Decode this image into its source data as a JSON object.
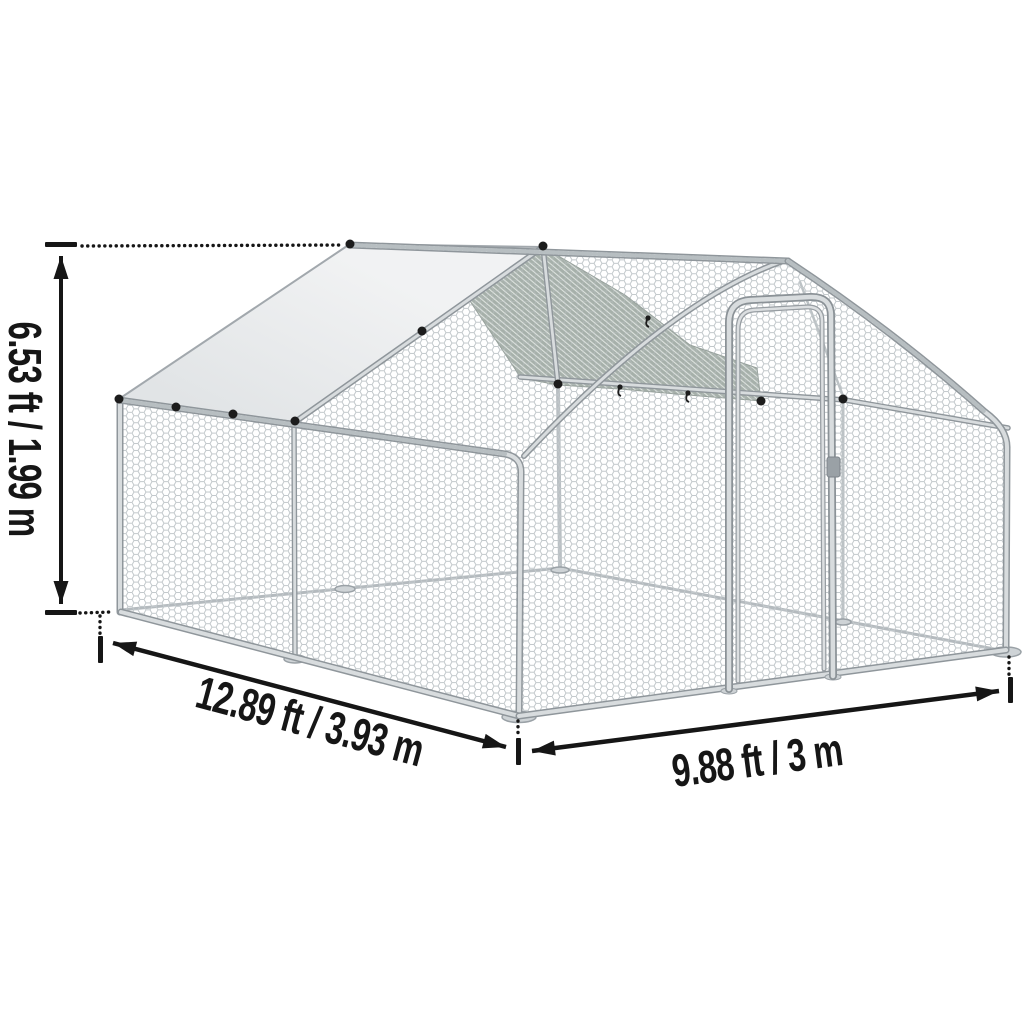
{
  "diagram": {
    "dimensions": {
      "height": "6.53 ft / 1.99 m",
      "length": "12.89 ft / 3.93 m",
      "width": "9.88 ft / 3 m"
    },
    "colors": {
      "background": "#ffffff",
      "annotation": "#161616",
      "mesh_line": "#c2c8cb",
      "frame_outline": "#8f969b",
      "frame_fill": "#d8dcde",
      "roof_cover": "#e8eaec",
      "shaded_roof_panel": "#a6b0aa",
      "clip": "#1c1c1c"
    }
  }
}
